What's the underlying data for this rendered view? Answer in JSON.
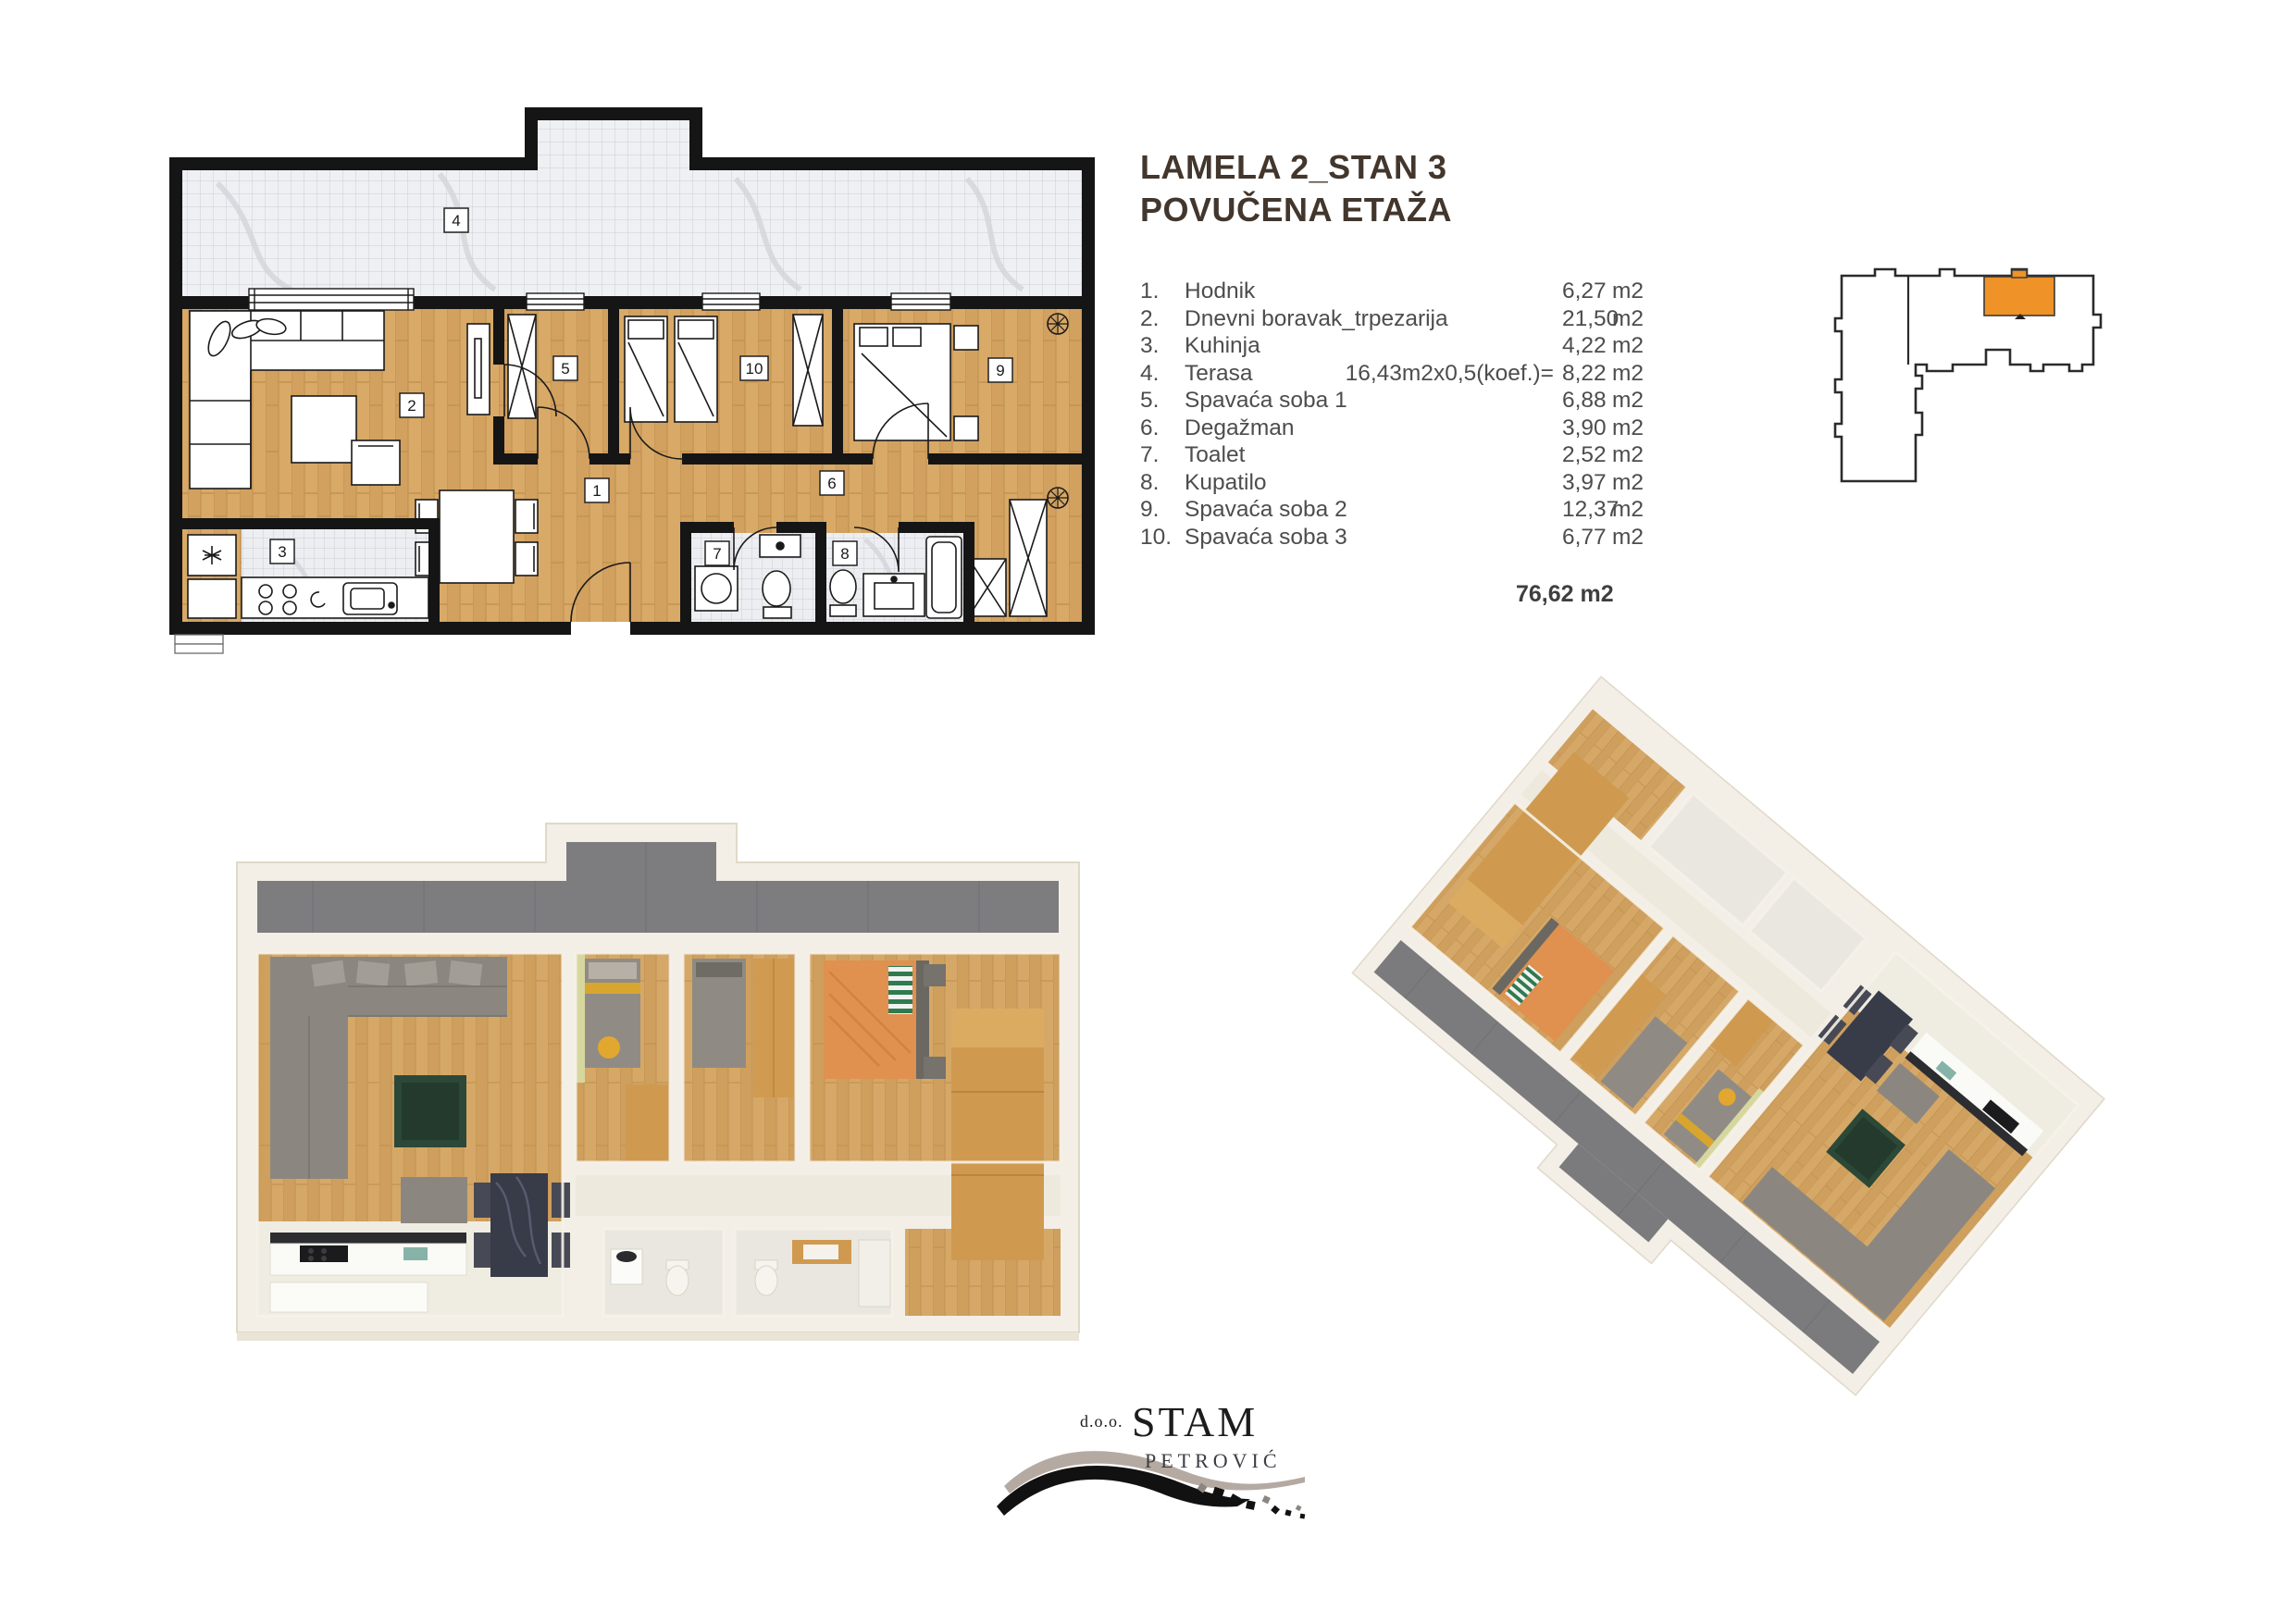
{
  "header": {
    "title_line1": "LAMELA 2_STAN 3",
    "title_line2": "POVUČENA ETAŽA"
  },
  "room_list": {
    "rows": [
      {
        "num": "1.",
        "name": "Hodnik",
        "note": "",
        "val": "6,27",
        "unit": "m2"
      },
      {
        "num": "2.",
        "name": "Dnevni boravak_trpezarija",
        "note": "",
        "val": "21,50",
        "unit": "m2"
      },
      {
        "num": "3.",
        "name": "Kuhinja",
        "note": "",
        "val": "4,22",
        "unit": "m2"
      },
      {
        "num": "4.",
        "name": "Terasa",
        "note": "16,43m2x0,5(koef.)=",
        "val": "8,22",
        "unit": "m2"
      },
      {
        "num": "5.",
        "name": "Spavaća soba 1",
        "note": "",
        "val": "6,88",
        "unit": "m2"
      },
      {
        "num": "6.",
        "name": "Degažman",
        "note": "",
        "val": "3,90",
        "unit": "m2"
      },
      {
        "num": "7.",
        "name": "Toalet",
        "note": "",
        "val": "2,52",
        "unit": "m2"
      },
      {
        "num": "8.",
        "name": "Kupatilo",
        "note": "",
        "val": "3,97",
        "unit": "m2"
      },
      {
        "num": "9.",
        "name": "Spavaća soba 2",
        "note": "",
        "val": "12,37",
        "unit": "m2"
      },
      {
        "num": "10.",
        "name": "Spavaća soba 3",
        "note": "",
        "val": "6,77",
        "unit": "m2"
      }
    ],
    "total": "76,62 m2"
  },
  "floorplan2d": {
    "labels": [
      "1",
      "2",
      "3",
      "4",
      "5",
      "6",
      "7",
      "8",
      "9",
      "10"
    ]
  },
  "logo": {
    "prefix": "d.o.o.",
    "name": "STAM",
    "subname": "PETROVIĆ"
  },
  "colors": {
    "accent_orange": "#EF9227",
    "wall_black": "#151515",
    "wood": "#D5A767",
    "terrace_gray": "#7D7D80",
    "tile_light": "#EEF0F3",
    "sofa_gray": "#8B8780",
    "table_green": "#2C4837",
    "wardrobe_wood": "#CF9A50",
    "bed_orange": "#E0904F",
    "title_text": "#42362D",
    "body_text": "#4D4D4D"
  }
}
